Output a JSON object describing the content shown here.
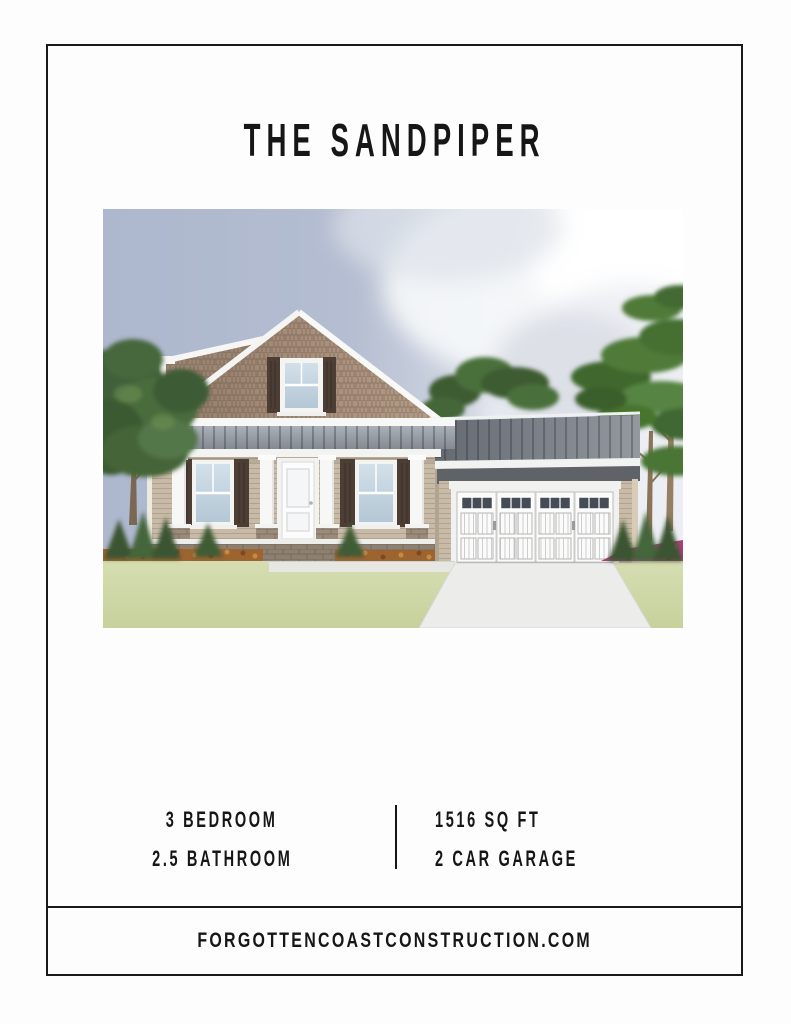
{
  "theme": {
    "page_bg": "#fdfdfd",
    "frame_border": "#1a1a1a",
    "text_color": "#161616"
  },
  "title": "THE SANDPIPER",
  "hero": {
    "alt": "Front elevation rendering of The Sandpiper: a tan shake-and-lap siding cottage with gray metal roof accents, covered front porch with white columns, dark brown shutters, brick skirt, attached two-car garage with white carriage doors, concrete driveway, lawn, shrubs, flower beds, leafy tree on the left and pine trees on the right under a blue-gray sky with clouds"
  },
  "specs": {
    "bedrooms": "3 BEDROOM",
    "bathrooms": "2.5 BATHROOM",
    "sqft": "1516 SQ FT",
    "garage": "2 CAR GARAGE"
  },
  "footer": {
    "website": "FORGOTTENCOASTCONSTRUCTION.COM"
  }
}
